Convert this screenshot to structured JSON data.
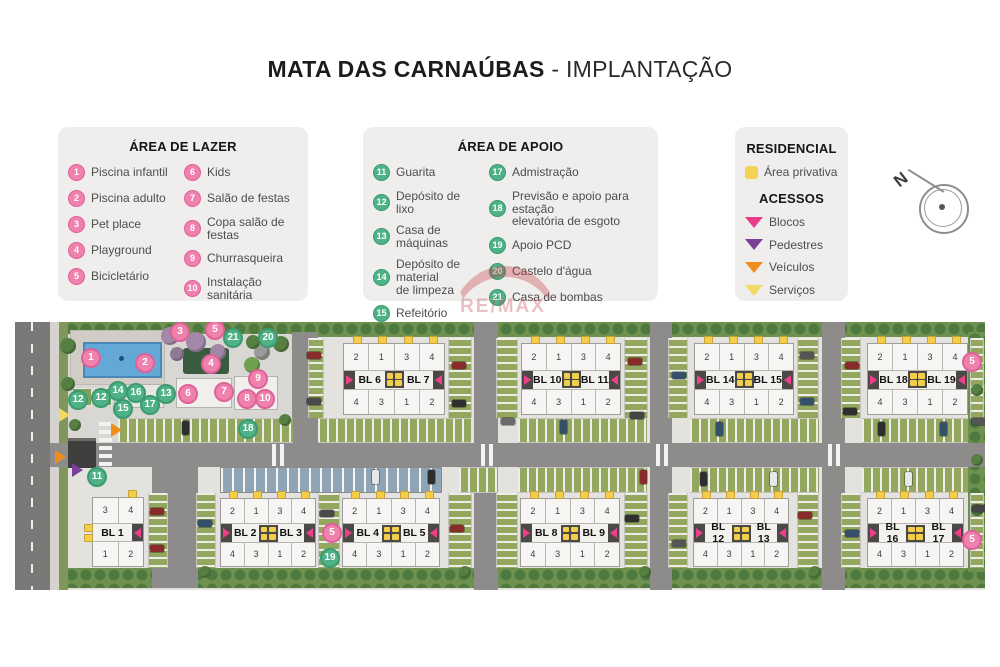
{
  "title": {
    "main": "MATA DAS CARNAÚBAS",
    "suffix": " - IMPLANTAÇÃO"
  },
  "watermark": {
    "text": "RE/MAX"
  },
  "compass": {
    "label": "N"
  },
  "legend_lazer": {
    "title": "ÁREA DE LAZER",
    "columns": [
      [
        {
          "num": "1",
          "label": "Piscina infantil"
        },
        {
          "num": "2",
          "label": "Piscina adulto"
        },
        {
          "num": "3",
          "label": "Pet place"
        },
        {
          "num": "4",
          "label": "Playground"
        },
        {
          "num": "5",
          "label": "Bicicletário"
        }
      ],
      [
        {
          "num": "6",
          "label": "Kids"
        },
        {
          "num": "7",
          "label": "Salão de festas"
        },
        {
          "num": "8",
          "label": "Copa salão de festas"
        },
        {
          "num": "9",
          "label": "Churrasqueira"
        },
        {
          "num": "10",
          "label": "Instalação sanitária"
        }
      ]
    ]
  },
  "legend_apoio": {
    "title": "ÁREA DE  APOIO",
    "columns": [
      [
        {
          "num": "11",
          "label": "Guarita"
        },
        {
          "num": "12",
          "label": "Depósito de lixo"
        },
        {
          "num": "13",
          "label": "Casa de máquinas"
        },
        {
          "num": "14",
          "label": "Depósito de material\nde limpeza"
        },
        {
          "num": "15",
          "label": "Refeitório"
        },
        {
          "num": "16",
          "label": "Vestiários"
        }
      ],
      [
        {
          "num": "17",
          "label": "Admistração"
        },
        {
          "num": "18",
          "label": "Previsão e apoio para estação\nelevatória de esgoto"
        },
        {
          "num": "19",
          "label": "Apoio PCD"
        },
        {
          "num": "20",
          "label": "Castelo d'água"
        },
        {
          "num": "21",
          "label": "Casa de bombas"
        }
      ]
    ]
  },
  "legend_residencial": {
    "title": "RESIDENCIAL",
    "items": [
      {
        "label": "Área privativa",
        "color": "#f4d254"
      }
    ]
  },
  "legend_acessos": {
    "title": "ACESSOS",
    "items": [
      {
        "label": "Blocos",
        "color": "#e73c88"
      },
      {
        "label": "Pedestres",
        "color": "#7b3f98"
      },
      {
        "label": "Veículos",
        "color": "#ef8e1c"
      },
      {
        "label": "Serviços",
        "color": "#f3da67"
      }
    ]
  },
  "siteplan": {
    "pair_top_units": [
      "2",
      "1",
      "3",
      "4"
    ],
    "pair_bottom_units": [
      "4",
      "3",
      "1",
      "2"
    ],
    "block_pairs": [
      {
        "left": "BL 6",
        "right": "BL 7",
        "x": 328,
        "y": 21,
        "w": 102,
        "h": 72
      },
      {
        "left": "BL 10",
        "right": "BL 11",
        "x": 506,
        "y": 21,
        "w": 100,
        "h": 72
      },
      {
        "left": "BL 14",
        "right": "BL 15",
        "x": 679,
        "y": 21,
        "w": 100,
        "h": 72
      },
      {
        "left": "BL 18",
        "right": "BL 19",
        "x": 852,
        "y": 21,
        "w": 101,
        "h": 72
      },
      {
        "left": "BL 2",
        "right": "BL 3",
        "x": 205,
        "y": 176,
        "w": 96,
        "h": 69
      },
      {
        "left": "BL 4",
        "right": "BL 5",
        "x": 327,
        "y": 176,
        "w": 98,
        "h": 69
      },
      {
        "left": "BL 8",
        "right": "BL 9",
        "x": 505,
        "y": 176,
        "w": 100,
        "h": 69
      },
      {
        "left": "BL 12",
        "right": "BL 13",
        "x": 678,
        "y": 176,
        "w": 96,
        "h": 69
      },
      {
        "left": "BL 16",
        "right": "BL 17",
        "x": 852,
        "y": 176,
        "w": 97,
        "h": 69
      }
    ],
    "single_blocks": [
      {
        "label": "BL 1",
        "x": 77,
        "y": 175,
        "w": 52,
        "h": 70,
        "top_units": [
          "3",
          "4"
        ],
        "bottom_units": [
          "1",
          "2"
        ]
      }
    ],
    "markers": [
      {
        "n": "1",
        "k": "p",
        "x": 76,
        "y": 36
      },
      {
        "n": "2",
        "k": "p",
        "x": 130,
        "y": 41
      },
      {
        "n": "3",
        "k": "p",
        "x": 165,
        "y": 10
      },
      {
        "n": "4",
        "k": "p",
        "x": 196,
        "y": 42
      },
      {
        "n": "5",
        "k": "p",
        "x": 200,
        "y": 8
      },
      {
        "n": "5",
        "k": "p",
        "x": 317,
        "y": 211
      },
      {
        "n": "5",
        "k": "p",
        "x": 957,
        "y": 40
      },
      {
        "n": "5",
        "k": "p",
        "x": 957,
        "y": 218
      },
      {
        "n": "6",
        "k": "p",
        "x": 173,
        "y": 72
      },
      {
        "n": "7",
        "k": "p",
        "x": 209,
        "y": 70
      },
      {
        "n": "8",
        "k": "p",
        "x": 232,
        "y": 77
      },
      {
        "n": "9",
        "k": "p",
        "x": 243,
        "y": 57
      },
      {
        "n": "10",
        "k": "p",
        "x": 250,
        "y": 77
      },
      {
        "n": "11",
        "k": "g",
        "x": 82,
        "y": 155
      },
      {
        "n": "12",
        "k": "g",
        "x": 63,
        "y": 78
      },
      {
        "n": "12",
        "k": "g",
        "x": 86,
        "y": 76
      },
      {
        "n": "13",
        "k": "g",
        "x": 151,
        "y": 72
      },
      {
        "n": "14",
        "k": "g",
        "x": 103,
        "y": 69
      },
      {
        "n": "15",
        "k": "g",
        "x": 108,
        "y": 87
      },
      {
        "n": "16",
        "k": "g",
        "x": 121,
        "y": 71
      },
      {
        "n": "17",
        "k": "g",
        "x": 135,
        "y": 83
      },
      {
        "n": "18",
        "k": "g",
        "x": 233,
        "y": 107
      },
      {
        "n": "19",
        "k": "g",
        "x": 315,
        "y": 236
      },
      {
        "n": "20",
        "k": "g",
        "x": 253,
        "y": 16
      },
      {
        "n": "21",
        "k": "g",
        "x": 218,
        "y": 16
      }
    ],
    "access_arrows": [
      {
        "type": "servicos",
        "color": "#f3da67",
        "x": 44,
        "y": 86
      },
      {
        "type": "veiculos",
        "color": "#ef8e1c",
        "x": 96,
        "y": 101
      },
      {
        "type": "veiculos",
        "color": "#ef8e1c",
        "x": 40,
        "y": 128
      },
      {
        "type": "pedestres",
        "color": "#7b3f98",
        "x": 57,
        "y": 141
      }
    ],
    "cars": [
      {
        "x": 292,
        "y": 30,
        "o": "h",
        "c": "#8a2b2b"
      },
      {
        "x": 292,
        "y": 76,
        "o": "h",
        "c": "#4a4a4a"
      },
      {
        "x": 437,
        "y": 40,
        "o": "h",
        "c": "#8a2b2b"
      },
      {
        "x": 437,
        "y": 78,
        "o": "h",
        "c": "#2e2e2e"
      },
      {
        "x": 486,
        "y": 96,
        "o": "h",
        "c": "#6b6b6b"
      },
      {
        "x": 613,
        "y": 36,
        "o": "h",
        "c": "#8a2b2b"
      },
      {
        "x": 615,
        "y": 90,
        "o": "h",
        "c": "#444444"
      },
      {
        "x": 657,
        "y": 50,
        "o": "h",
        "c": "#35506b"
      },
      {
        "x": 785,
        "y": 30,
        "o": "h",
        "c": "#555555"
      },
      {
        "x": 785,
        "y": 76,
        "o": "h",
        "c": "#35506b"
      },
      {
        "x": 830,
        "y": 40,
        "o": "h",
        "c": "#8a2b2b"
      },
      {
        "x": 828,
        "y": 86,
        "o": "h",
        "c": "#2e2e2e"
      },
      {
        "x": 957,
        "y": 96,
        "o": "h",
        "c": "#555555"
      },
      {
        "x": 135,
        "y": 186,
        "o": "h",
        "c": "#8a2b2b"
      },
      {
        "x": 135,
        "y": 223,
        "o": "h",
        "c": "#8a2b2b"
      },
      {
        "x": 183,
        "y": 198,
        "o": "h",
        "c": "#35506b"
      },
      {
        "x": 305,
        "y": 188,
        "o": "h",
        "c": "#4a4a4a"
      },
      {
        "x": 435,
        "y": 203,
        "o": "h",
        "c": "#8a2b2b"
      },
      {
        "x": 610,
        "y": 193,
        "o": "h",
        "c": "#2e2e2e"
      },
      {
        "x": 657,
        "y": 218,
        "o": "h",
        "c": "#555555"
      },
      {
        "x": 783,
        "y": 190,
        "o": "h",
        "c": "#8a2b2b"
      },
      {
        "x": 830,
        "y": 208,
        "o": "h",
        "c": "#35506b"
      },
      {
        "x": 957,
        "y": 183,
        "o": "h",
        "c": "#444444"
      },
      {
        "x": 167,
        "y": 99,
        "o": "v",
        "c": "#2e2e2e"
      },
      {
        "x": 229,
        "y": 98,
        "o": "v",
        "c": "#555555"
      },
      {
        "x": 357,
        "y": 148,
        "o": "v",
        "c": "#e8e8e8"
      },
      {
        "x": 413,
        "y": 148,
        "o": "v",
        "c": "#2e2e2e"
      },
      {
        "x": 545,
        "y": 98,
        "o": "v",
        "c": "#35506b"
      },
      {
        "x": 625,
        "y": 148,
        "o": "v",
        "c": "#8a2b2b"
      },
      {
        "x": 701,
        "y": 100,
        "o": "v",
        "c": "#35506b"
      },
      {
        "x": 685,
        "y": 150,
        "o": "v",
        "c": "#2e2e2e"
      },
      {
        "x": 755,
        "y": 150,
        "o": "v",
        "c": "#e8e8e8"
      },
      {
        "x": 863,
        "y": 100,
        "o": "v",
        "c": "#2e2e2e"
      },
      {
        "x": 890,
        "y": 150,
        "o": "v",
        "c": "#e8e8e8"
      },
      {
        "x": 925,
        "y": 100,
        "o": "v",
        "c": "#35506b"
      }
    ],
    "trees": [
      {
        "x": 155,
        "y": 14,
        "r": 9,
        "c": "#a387a8"
      },
      {
        "x": 181,
        "y": 20,
        "r": 10,
        "c": "#a387a8"
      },
      {
        "x": 203,
        "y": 30,
        "r": 8,
        "c": "#a387a8"
      },
      {
        "x": 162,
        "y": 32,
        "r": 7,
        "c": "#8f7a95"
      },
      {
        "x": 53,
        "y": 24,
        "r": 8,
        "c": "#567f42"
      },
      {
        "x": 53,
        "y": 62,
        "r": 7,
        "c": "#567f42"
      },
      {
        "x": 266,
        "y": 22,
        "r": 8,
        "c": "#567f42"
      },
      {
        "x": 238,
        "y": 20,
        "r": 7,
        "c": "#567f42"
      },
      {
        "x": 237,
        "y": 43,
        "r": 8,
        "c": "#6da04f"
      },
      {
        "x": 270,
        "y": 98,
        "r": 6,
        "c": "#567f42"
      },
      {
        "x": 60,
        "y": 103,
        "r": 6,
        "c": "#567f42"
      },
      {
        "x": 962,
        "y": 68,
        "r": 6,
        "c": "#567f42"
      },
      {
        "x": 962,
        "y": 138,
        "r": 6,
        "c": "#567f42"
      },
      {
        "x": 962,
        "y": 188,
        "r": 6,
        "c": "#567f42"
      },
      {
        "x": 190,
        "y": 250,
        "r": 6,
        "c": "#567f42"
      },
      {
        "x": 450,
        "y": 250,
        "r": 6,
        "c": "#567f42"
      },
      {
        "x": 630,
        "y": 250,
        "r": 6,
        "c": "#567f42"
      },
      {
        "x": 800,
        "y": 250,
        "r": 6,
        "c": "#567f42"
      }
    ]
  }
}
